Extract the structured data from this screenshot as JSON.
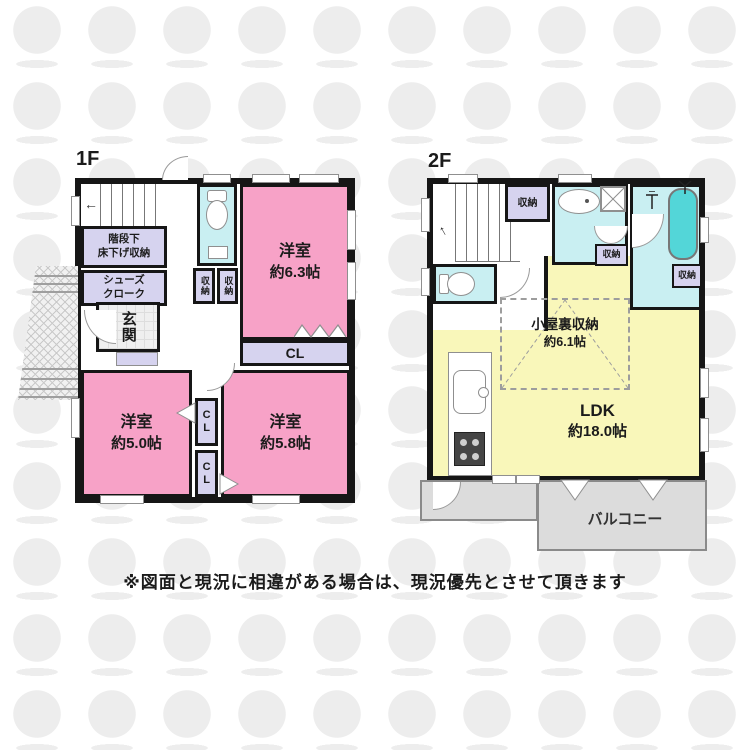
{
  "colors": {
    "wall": "#161616",
    "room-pink": "#f7a2c7",
    "storage-lav": "#d6d3ef",
    "wet-cyan": "#c9eff2",
    "ldk-yellow": "#f9f7ba",
    "balcony-gray": "#dcdcdc",
    "tub-teal": "#53d6d8"
  },
  "floor1": {
    "label": "1F",
    "under_stairs_line1": "階段下",
    "under_stairs_line2": "床下げ収納",
    "shoes_line1": "シューズ",
    "shoes_line2": "クローク",
    "entrance": "玄関",
    "storage_a": "収納",
    "storage_b": "収納",
    "bedroom63_name": "洋室",
    "bedroom63_size": "約6.3帖",
    "cl_top": "CL",
    "bedroom50_name": "洋室",
    "bedroom50_size": "約5.0帖",
    "cl_mid": "CL",
    "cl_bottom": "CL",
    "bedroom58_name": "洋室",
    "bedroom58_size": "約5.8帖"
  },
  "floor2": {
    "label": "2F",
    "storage_top": "収納",
    "storage_mid": "収納",
    "storage_right": "収納",
    "attic_name": "小屋裏収納",
    "attic_size": "約6.1帖",
    "ldk_name": "LDK",
    "ldk_size": "約18.0帖",
    "balcony": "バルコニー"
  },
  "icons": {
    "stairs_up_arrow_1f": "←",
    "stairs_up_arrow_2f": "↑"
  },
  "note": "※図面と現況に相違がある場合は、現況優先とさせて頂きます"
}
